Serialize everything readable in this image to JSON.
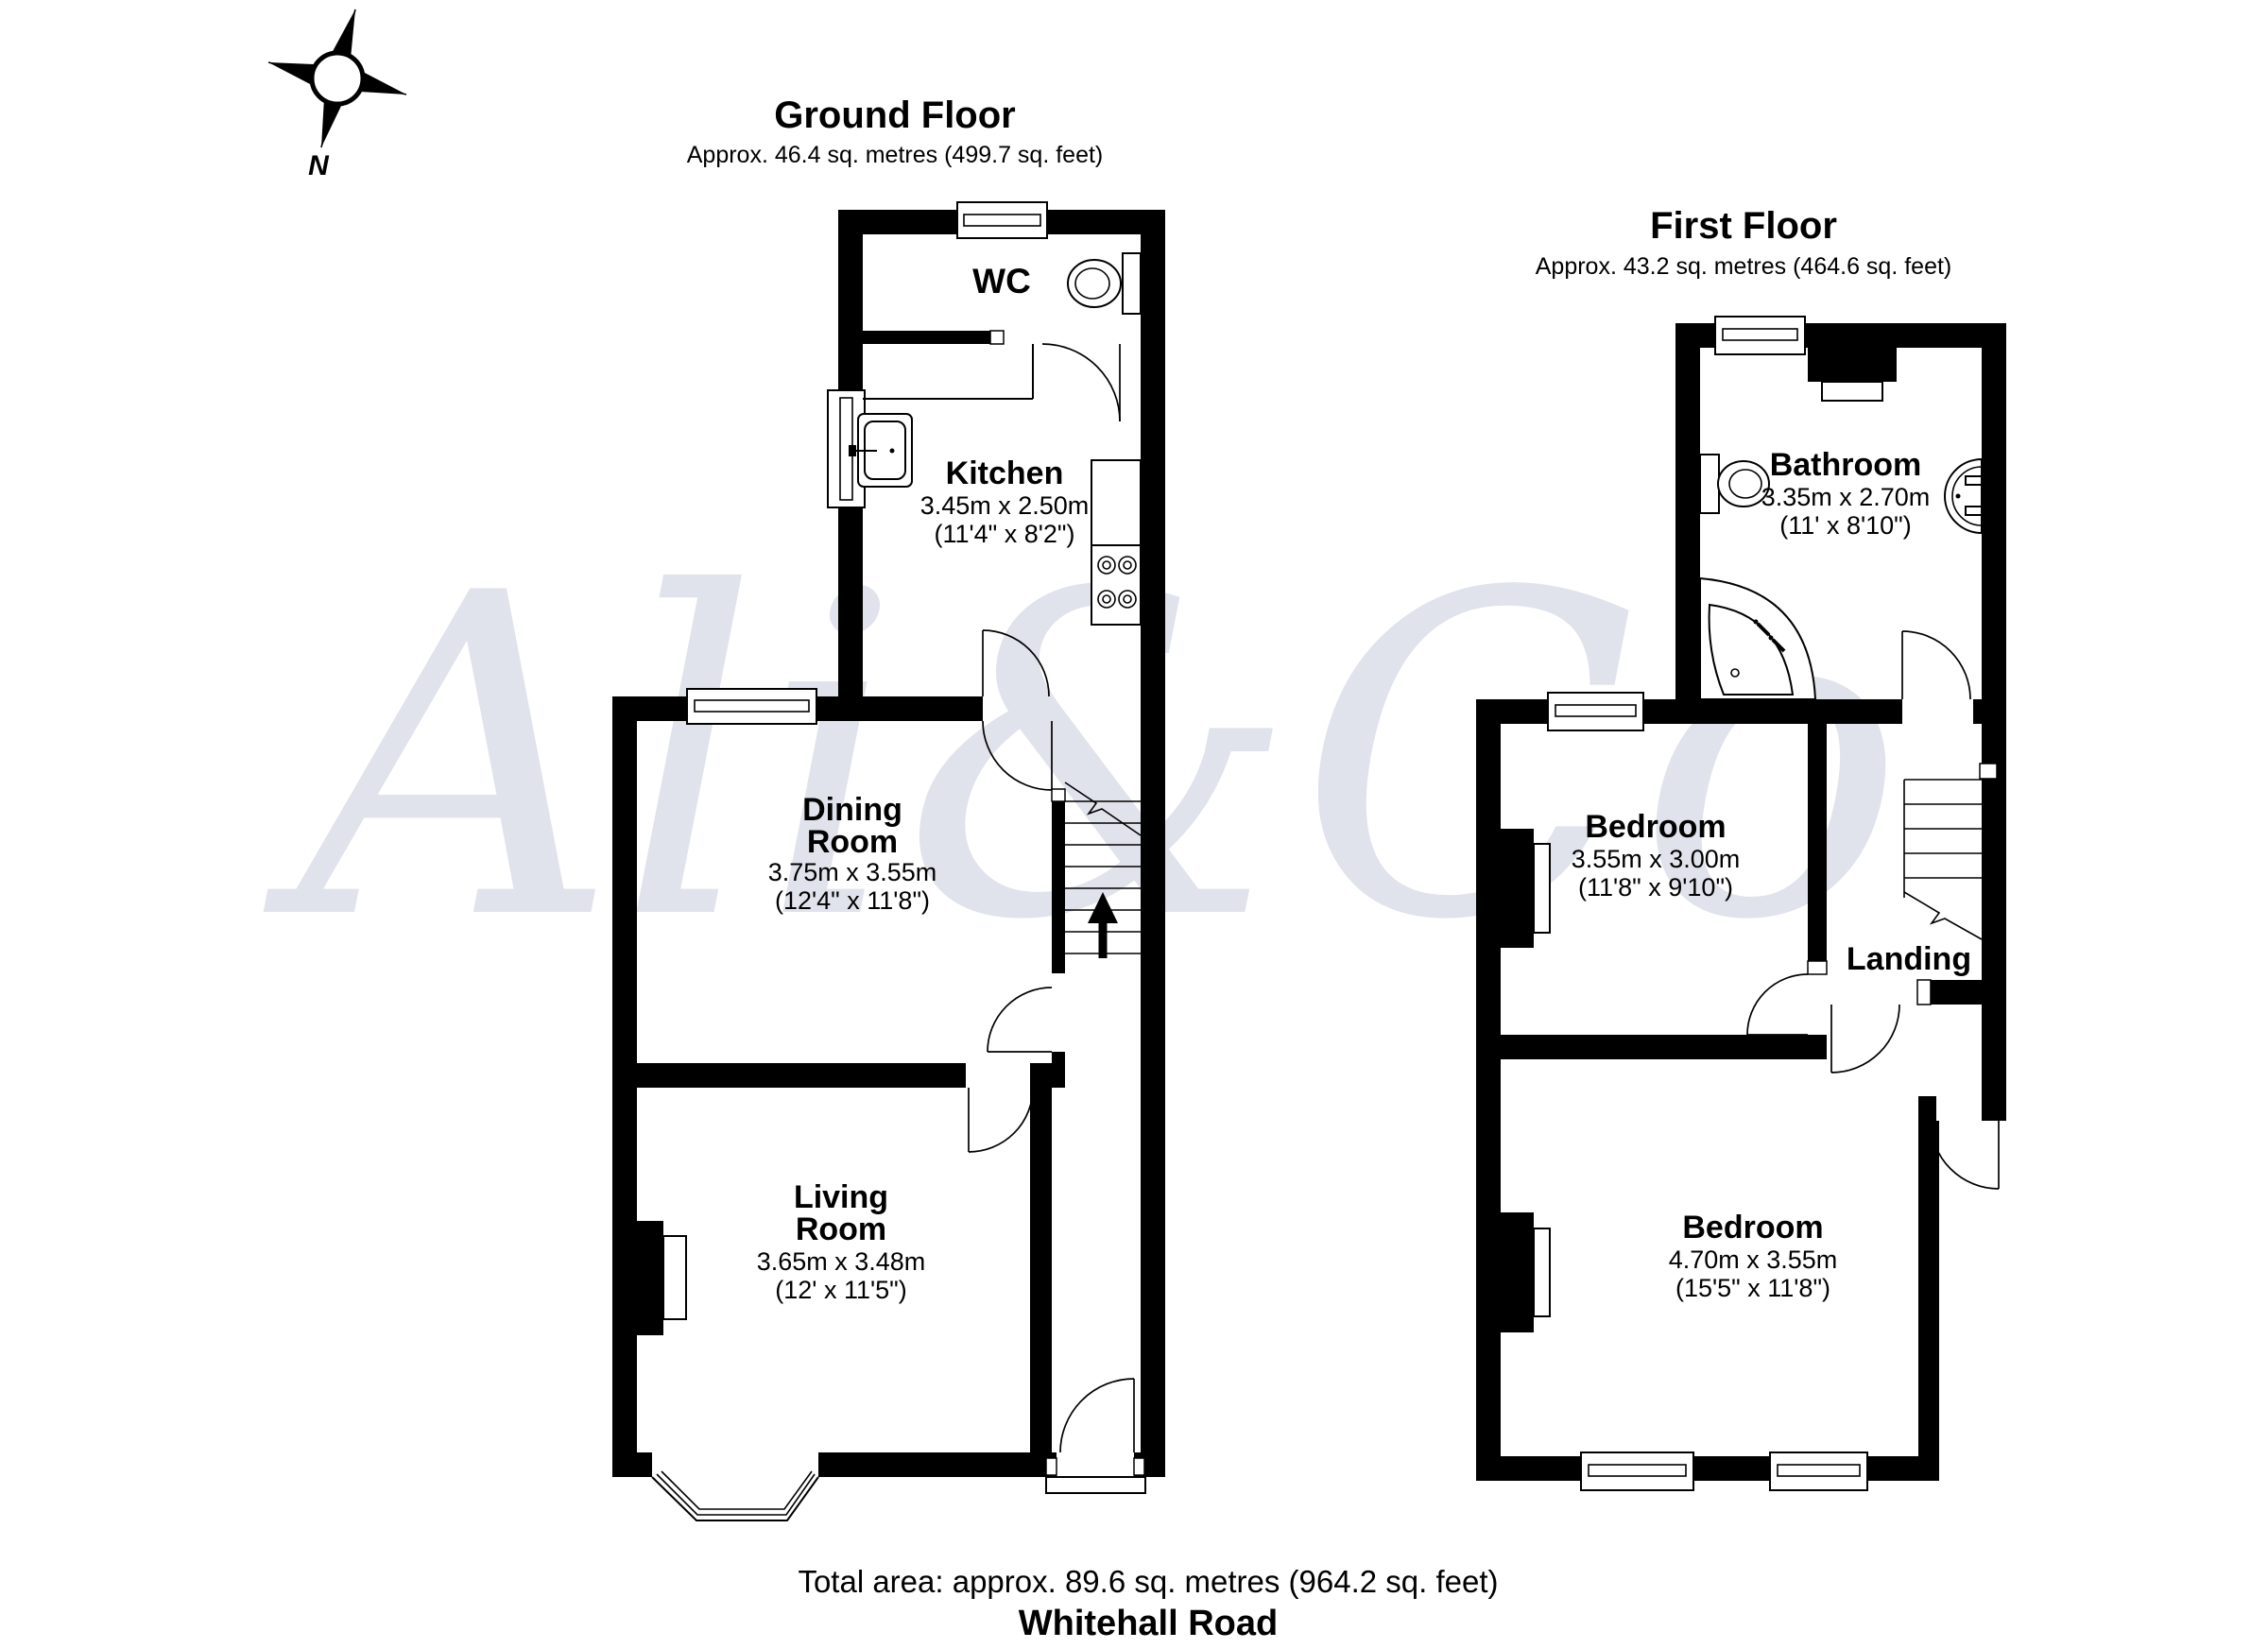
{
  "compass": {
    "north_label": "N"
  },
  "watermark": {
    "text": "Ali&Co"
  },
  "ground_floor": {
    "title": "Ground Floor",
    "area": "Approx. 46.4 sq. metres (499.7 sq. feet)",
    "rooms": {
      "wc": {
        "name": "WC"
      },
      "kitchen": {
        "name": "Kitchen",
        "size_metric": "3.45m x 2.50m",
        "size_imperial": "(11'4\" x 8'2\")"
      },
      "dining": {
        "name_line1": "Dining",
        "name_line2": "Room",
        "size_metric": "3.75m x 3.55m",
        "size_imperial": "(12'4\" x 11'8\")"
      },
      "living": {
        "name_line1": "Living",
        "name_line2": "Room",
        "size_metric": "3.65m x 3.48m",
        "size_imperial": "(12' x 11'5\")"
      }
    }
  },
  "first_floor": {
    "title": "First Floor",
    "area": "Approx. 43.2 sq. metres (464.6 sq. feet)",
    "rooms": {
      "bathroom": {
        "name": "Bathroom",
        "size_metric": "3.35m x 2.70m",
        "size_imperial": "(11' x 8'10\")"
      },
      "bedroom1": {
        "name": "Bedroom",
        "size_metric": "3.55m x 3.00m",
        "size_imperial": "(11'8\" x 9'10\")"
      },
      "landing": {
        "name": "Landing"
      },
      "bedroom2": {
        "name": "Bedroom",
        "size_metric": "4.70m x 3.55m",
        "size_imperial": "(15'5\" x 11'8\")"
      }
    }
  },
  "footer": {
    "total_area": "Total area: approx. 89.6 sq. metres (964.2 sq. feet)",
    "street_name": "Whitehall Road"
  }
}
